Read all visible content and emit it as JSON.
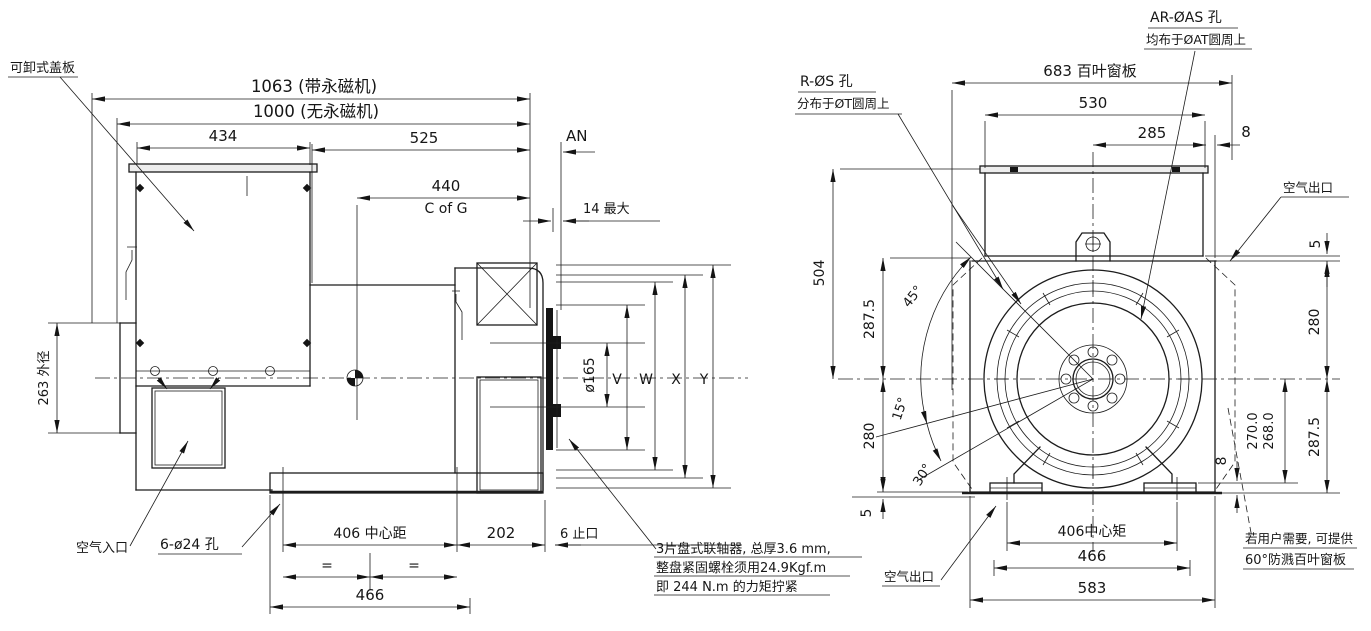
{
  "side": {
    "cover_label": "可卸式盖板",
    "d1063": "1063 (带永磁机)",
    "d1000": "1000 (无永磁机)",
    "d434": "434",
    "d525": "525",
    "an": "AN",
    "d440": "440",
    "cofg": "C of G",
    "d14max": "14 最大",
    "d263": "263 外径",
    "d165": "ø165",
    "v": "V",
    "w": "W",
    "x": "X",
    "y": "Y",
    "air_inlet": "空气入口",
    "holes": "6-ø24 孔",
    "d406": "406 中心距",
    "eq1": "=",
    "eq2": "=",
    "d466": "466",
    "d202": "202",
    "spigot": "6 止口",
    "note1": "3片盘式联轴器, 总厚3.6 mm,",
    "note2": "整盘紧固螺栓须用24.9Kgf.m",
    "note3": "即 244 N.m 的力矩拧紧"
  },
  "front": {
    "ar1": "AR-ØAS 孔",
    "ar2": "均布于ØAT圆周上",
    "r1": "R-ØS 孔",
    "r2": "分布于ØT圆周上",
    "d683": "683 百叶窗板",
    "d530": "530",
    "d285": "285",
    "d8top": "8",
    "air_outlet_top": "空气出口",
    "d5top": "5",
    "d280r": "280",
    "d287r": "287.5",
    "d270": "270.0",
    "d268": "268.0",
    "d8r": "8",
    "d504": "504",
    "d287l": "287.5",
    "d280l": "280",
    "d5l": "5",
    "a45": "45°",
    "a15": "15°",
    "a30": "30°",
    "air_outlet_bottom": "空气出口",
    "d406": "406中心矩",
    "d466": "466",
    "d583": "583",
    "note1": "若用户需要, 可提供",
    "note2": "60°防溅百叶窗板"
  }
}
